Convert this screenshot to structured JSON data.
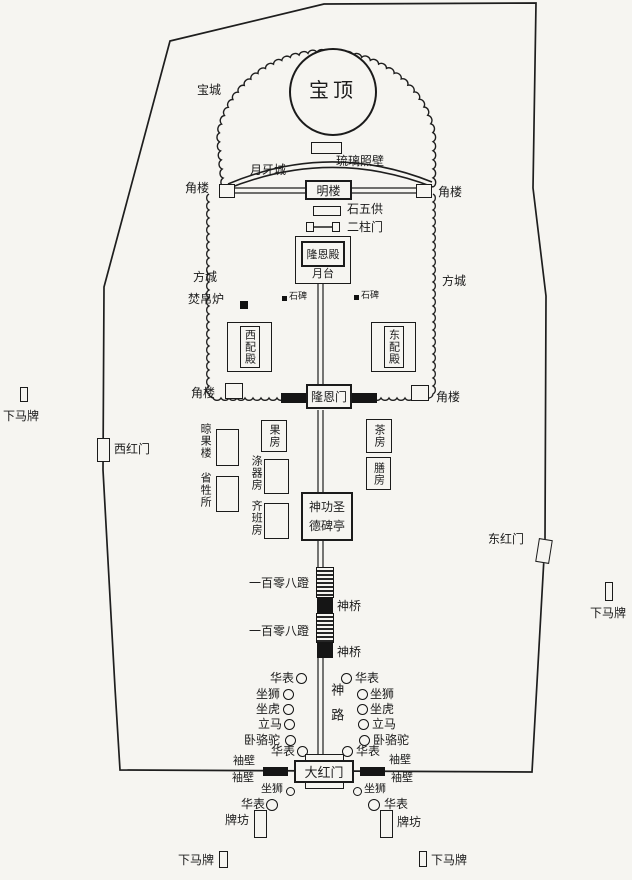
{
  "diagram": {
    "paper_color": "#f6f5f1",
    "ink_color": "#1e1e1e"
  },
  "labels": {
    "baoding": "宝顶",
    "baocheng": "宝城",
    "yueyacheng": "月牙城",
    "liulizhaobi": "琉璃照壁",
    "minglou": "明楼",
    "jiaolou": "角楼",
    "shiwugong": "石五供",
    "erzhumen": "二柱门",
    "longendian": "隆恩殿",
    "yuetai": "月台",
    "fangcheng": "方城",
    "fenbolu": "焚帛炉",
    "shibei": "石碑",
    "xipeidian": "西配殿",
    "dongpeidian": "东配殿",
    "longenmen": "隆恩门",
    "liangguolou": "晾果楼",
    "shengshengsuo": "省牲所",
    "guofang": "果房",
    "diqifang": "涤器房",
    "qibanfang": "齐班房",
    "chafang": "茶房",
    "shanfang": "膳房",
    "beiting": "神功圣德碑亭",
    "yibailingbadeng": "一百零八蹬",
    "shenqiao": "神桥",
    "shenlu": "神路",
    "huabiao": "华表",
    "zuoshi": "坐狮",
    "zuohu": "坐虎",
    "lima": "立马",
    "woluotuo": "卧骆驼",
    "xiubi": "袖壁",
    "dahongmen": "大红门",
    "paifang": "牌坊",
    "xiamapai": "下马牌",
    "xihongmen": "西红门",
    "donghongmen": "东红门"
  }
}
